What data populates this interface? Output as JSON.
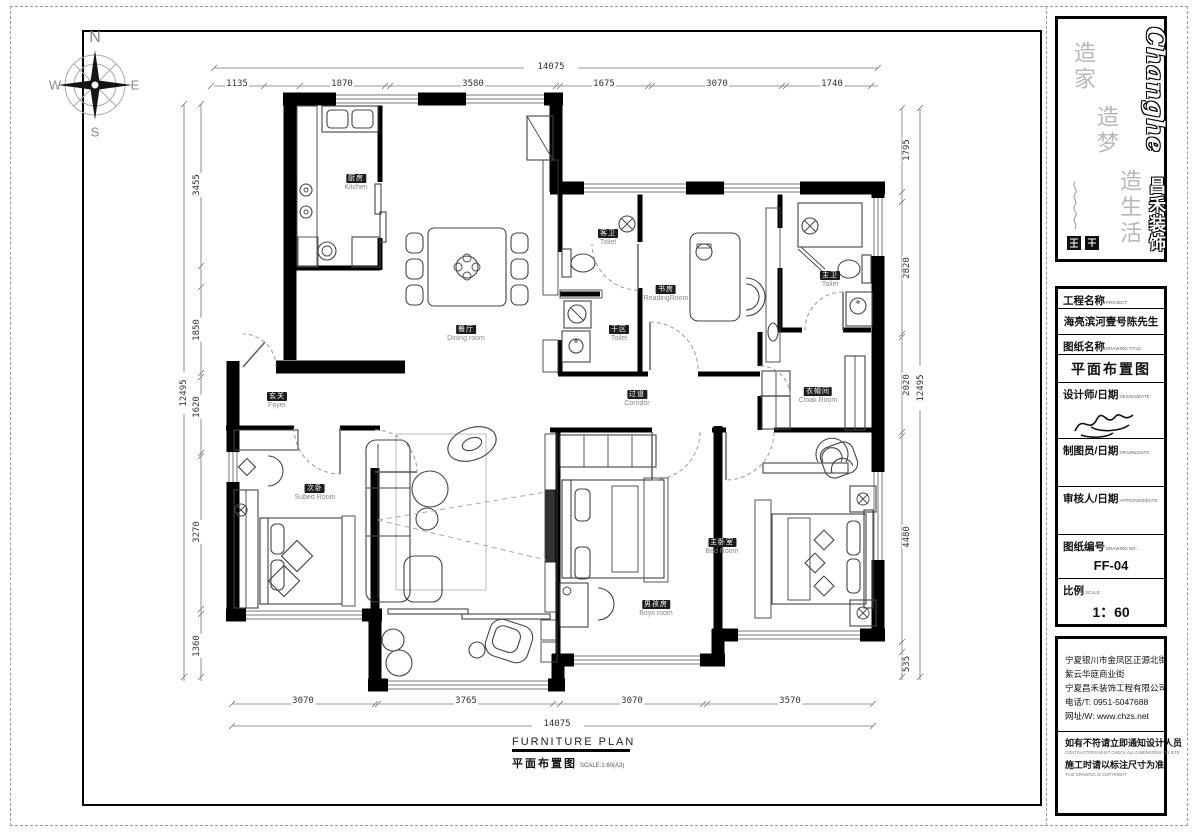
{
  "compass": {
    "n": "N",
    "w": "W",
    "e": "E",
    "s": "S"
  },
  "plan_title": {
    "en": "FURNITURE PLAN",
    "zh": "平面布置图",
    "scale": "SCALE:1:60(A3)"
  },
  "rooms": [
    {
      "zh": "厨房",
      "en": "Kitchen"
    },
    {
      "zh": "餐厅",
      "en": "Dining room"
    },
    {
      "zh": "客卫",
      "en": "Toilet"
    },
    {
      "zh": "干区",
      "en": "Toilet"
    },
    {
      "zh": "书房",
      "en": "ReadingRoom"
    },
    {
      "zh": "主卫",
      "en": "Toilet"
    },
    {
      "zh": "衣帽间",
      "en": "Cloak Room"
    },
    {
      "zh": "玄关",
      "en": "Foyer"
    },
    {
      "zh": "过道",
      "en": "Corridor"
    },
    {
      "zh": "次卧",
      "en": "Subed Room"
    },
    {
      "zh": "男孩房",
      "en": "Boys room"
    },
    {
      "zh": "主卧室",
      "en": "Bed Room"
    }
  ],
  "dims": {
    "top": [
      "1135",
      "1870",
      "3580",
      "1675",
      "3070",
      "1740"
    ],
    "top_total": "14075",
    "bottom": [
      "3070",
      "3765",
      "3070",
      "3570"
    ],
    "bottom_total": "14075",
    "left": [
      "3455",
      "1850",
      "1620",
      "3270",
      "1360"
    ],
    "left_total": "12495",
    "right": [
      "1795",
      "2820",
      "2020",
      "4480",
      "535"
    ],
    "right_total": "12495"
  },
  "title_block": {
    "brand": {
      "latin": "Changhe",
      "cn": "昌禾装饰",
      "slogan1": "造家",
      "slogan2": "造梦",
      "slogan3": "造生活"
    },
    "fields": [
      {
        "label": "工程名称",
        "sub": "PROJECT:",
        "value": "海亮滨河壹号陈先生雅居"
      },
      {
        "label": "图纸名称",
        "sub": "DRAWING TITLE:",
        "value": "平面布置图"
      },
      {
        "label": "设计师/日期",
        "sub": "DESIGN/DATE:",
        "value": ""
      },
      {
        "label": "制图员/日期",
        "sub": "DRAWN/DATE:",
        "value": ""
      },
      {
        "label": "审核人/日期",
        "sub": "APPROVED/DATE:",
        "value": ""
      },
      {
        "label": "图纸编号",
        "sub": "DRAWING NO.:",
        "value": "FF-04"
      },
      {
        "label": "比例",
        "sub": "SCALE:",
        "value": "1：60"
      }
    ],
    "company": {
      "addr1": "宁夏银川市金凤区正源北街",
      "addr2": "紫云华庭商业街",
      "addr3": "宁夏昌禾装饰工程有限公司",
      "phone": "电话/T: 0951-5047688",
      "web": "网址/W: www.chzs.net"
    },
    "notes": [
      {
        "zh": "如有不符请立即通知设计人员",
        "en": "CONTRACTORS MUST CHECK ALL DIMENSIONS ON SITE"
      },
      {
        "zh": "施工时请以标注尺寸为准",
        "en": "THIS DRAWING IS COPYRIGHT"
      }
    ]
  },
  "colors": {
    "wall": "#000000",
    "line": "#444444",
    "label_bg": "#1c1c1c",
    "dim_text": "#333333"
  }
}
